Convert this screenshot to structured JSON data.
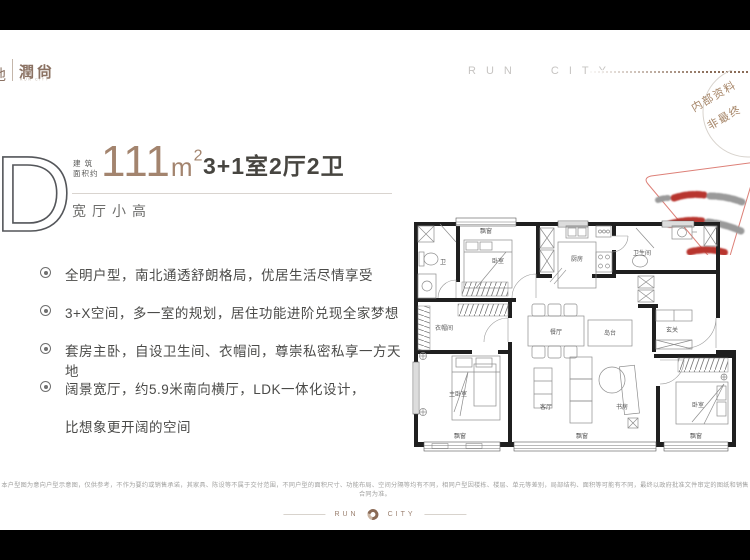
{
  "header": {
    "logo_partial": "地",
    "logo_name": "潤尙",
    "logo_sub": "RUN CITY",
    "brand_right": "RUN CITY"
  },
  "stamp": {
    "line1": "内部资料",
    "line2": "非最终"
  },
  "unit": {
    "letter": "D",
    "area_prefix_line1": "建 筑",
    "area_prefix_line2": "面积约",
    "area_value": "111",
    "area_unit": "m",
    "area_sup": "2",
    "rooms": "3+1室2厅2卫",
    "tagline": "宽厅小高"
  },
  "features": [
    "全明户型，南北通透舒朗格局，优居生活尽情享受",
    "3+X空间，多一室的规划，居住功能进阶兑现全家梦想",
    "套房主卧，自设卫生间、衣帽间，尊崇私密私享一方天地",
    "阔景宽厅，约5.9米南向横厅，LDK一体化设计，",
    "比想象更开阔的空间"
  ],
  "floorplan": {
    "labels": {
      "bay_top": "飘窗",
      "bedroom_top": "卧室",
      "bath_left": "卫",
      "kitchen": "厨房",
      "bath_right": "卫生间",
      "cloakroom": "衣帽间",
      "dining": "餐厅",
      "island": "岛台",
      "entry": "玄关",
      "master": "主卧室",
      "living": "客厅",
      "study": "书房",
      "bedroom_right": "卧室",
      "bay_master": "飘窗",
      "bay_living": "飘窗",
      "bay_right": "飘窗"
    }
  },
  "disclaimer": "本户型图为意向户型示意图，仅供参考，不作为要约或销售承诺，其家具、陈设等不属于交付范围，不同户型的面积尺寸、功能布局、空间分隔等均有不同，相同户型因楼栋、楼层、单元等差别，局部结构、面积等可能有不同，最终以政府批准文件审定的图纸和销售合同为准。",
  "footer": {
    "left": "RUN",
    "right": "CITY"
  },
  "colors": {
    "accent_brown": "#a3846e",
    "logo_brown": "#8b7263",
    "stamp_red": "#b8362e",
    "text_dark": "#474540",
    "letterbox": "#000000"
  }
}
